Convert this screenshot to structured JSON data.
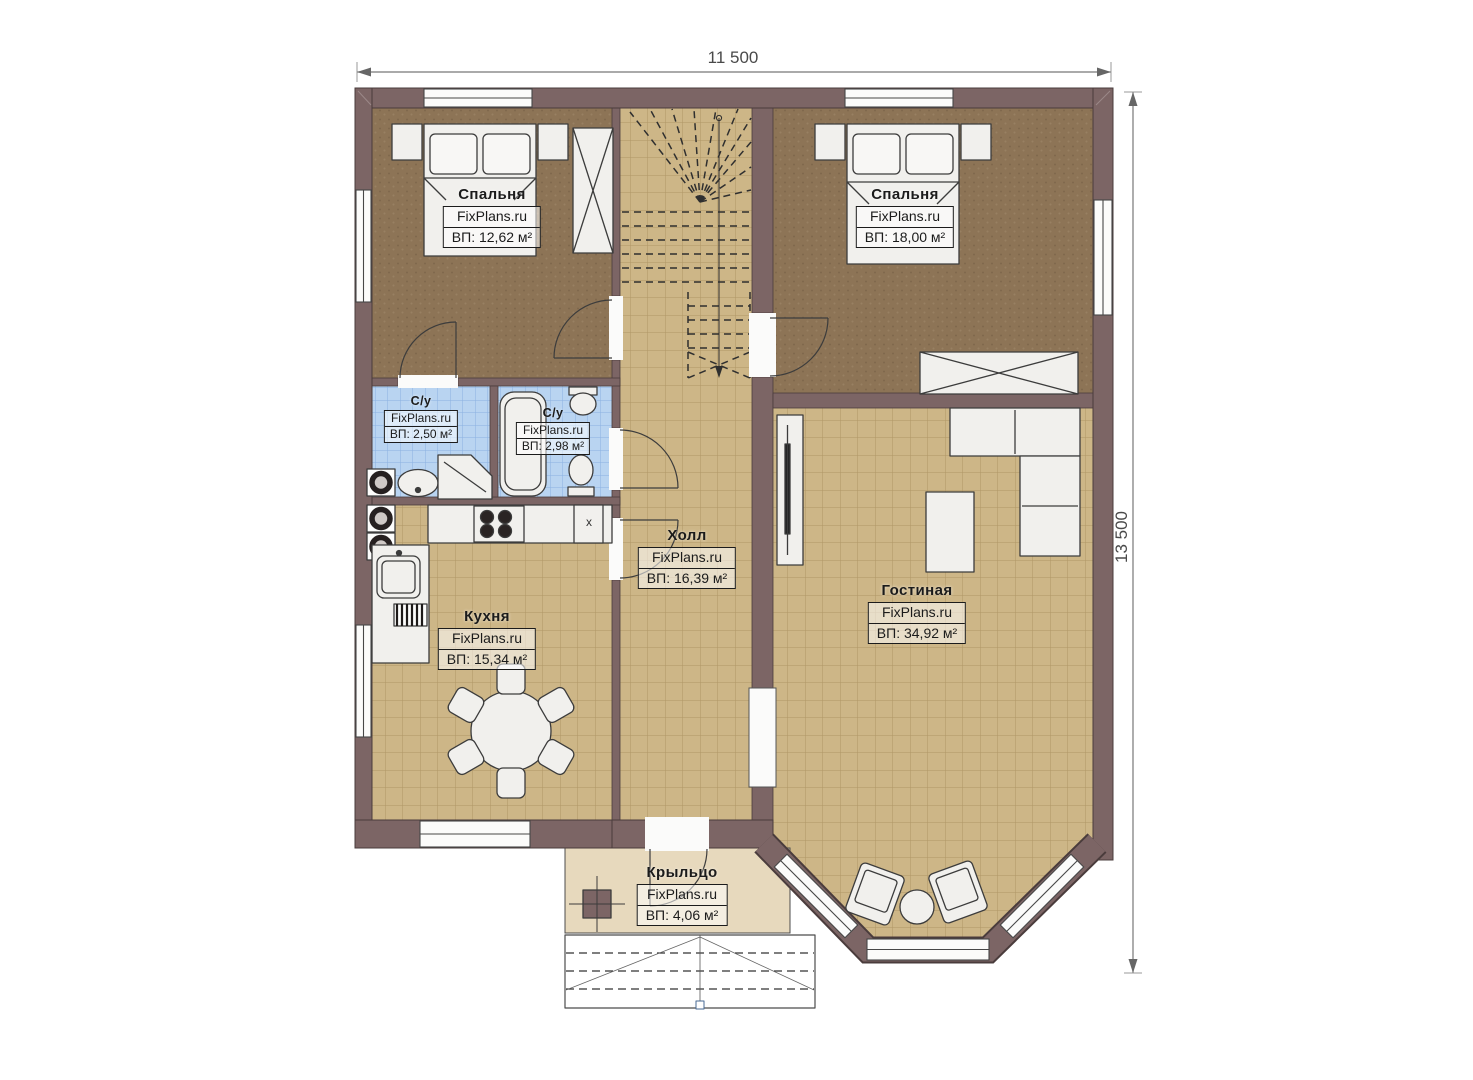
{
  "dimensions": {
    "width": "11 500",
    "height": "13 500"
  },
  "rooms": [
    {
      "key": "bedroom-left",
      "name": "Спальня",
      "brand": "FixPlans.ru",
      "area": "ВП: 12,62 м²"
    },
    {
      "key": "bedroom-right",
      "name": "Спальня",
      "brand": "FixPlans.ru",
      "area": "ВП: 18,00 м²"
    },
    {
      "key": "bathroom-left",
      "name": "С/у",
      "brand": "FixPlans.ru",
      "area": "ВП: 2,50 м²"
    },
    {
      "key": "bathroom-right",
      "name": "С/у",
      "brand": "FixPlans.ru",
      "area": "ВП: 2,98 м²"
    },
    {
      "key": "hall",
      "name": "Холл",
      "brand": "FixPlans.ru",
      "area": "ВП: 16,39 м²"
    },
    {
      "key": "kitchen",
      "name": "Кухня",
      "brand": "FixPlans.ru",
      "area": "ВП: 15,34 м²"
    },
    {
      "key": "living-room",
      "name": "Гостиная",
      "brand": "FixPlans.ru",
      "area": "ВП: 34,92 м²"
    },
    {
      "key": "porch",
      "name": "Крыльцо",
      "brand": "FixPlans.ru",
      "area": "ВП: 4,06 м²"
    }
  ],
  "markers": {
    "kitchen_appliance": "x"
  },
  "colors": {
    "wall": "#7c6565",
    "wall_outline": "#4a3c3c",
    "carpet": "#8d7456",
    "tile": "#cdb687",
    "bath_tile": "#b9d4f1",
    "porch": "#e7d9bd",
    "fixture": "#f1f0ed",
    "dimension_text": "#4a4a4a"
  }
}
